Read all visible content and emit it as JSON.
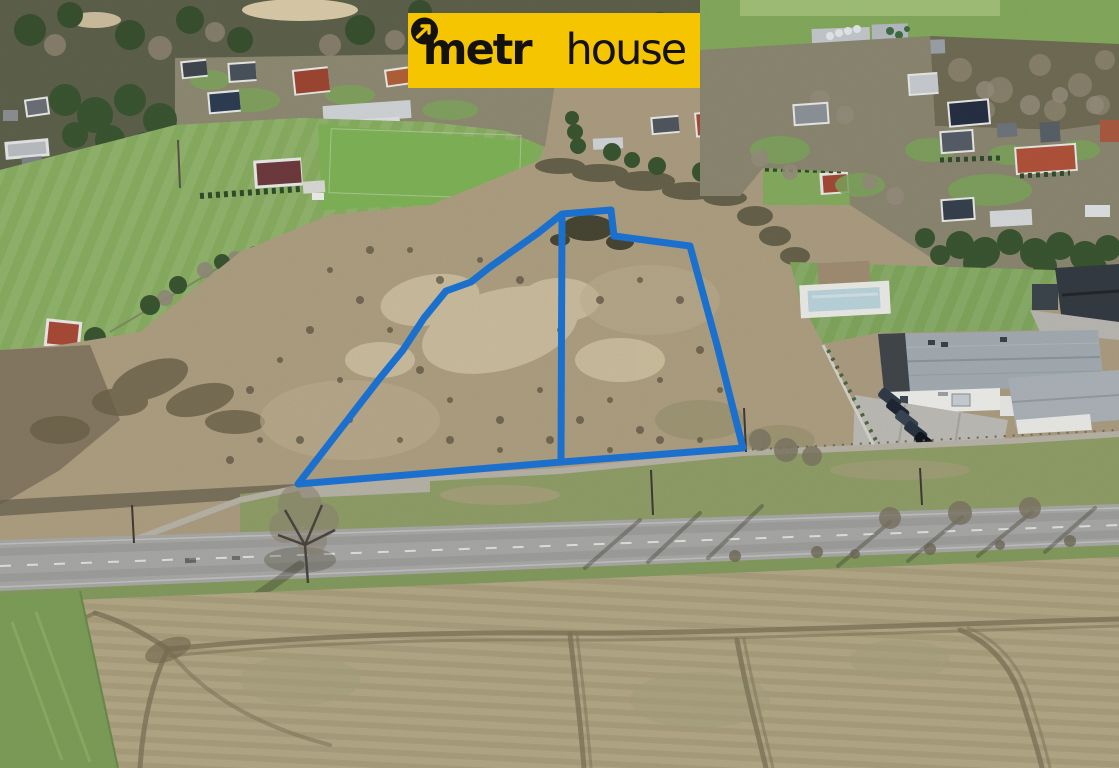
{
  "image": {
    "kind": "aerial-drone-photograph",
    "subject": "undeveloped land plots outlined in blue between a village, a service building with parking, a road and a plowed field"
  },
  "brand": {
    "name": "metrohouse",
    "part1": "metr",
    "part2": "house",
    "o_icon": "metrohouse-o-arrow-icon",
    "bg_color": "#F6C502",
    "text_color": "#141210"
  },
  "overlay": {
    "stroke_color": "#1B70CE",
    "stroke_width": "7",
    "main_plot_points": "298,484 380,378 403,350 424,318 446,291 471,282 490,267 538,233 562,214 611,210 614,236 690,246 717,345 743,448 562,462",
    "divider_points": "562,218 561,461"
  },
  "palette": {
    "meadow_green": "#87ad60",
    "scrub_brown": "#ab9c80",
    "sand_patch": "#cfc2a2",
    "road_gray": "#a7a7a5",
    "plowed_field": "#b2a785",
    "conifer_green": "#3a5531",
    "roof_red": "#a64a36",
    "roof_dark": "#2c3a50",
    "building_roof_gray": "#a2abb1"
  }
}
